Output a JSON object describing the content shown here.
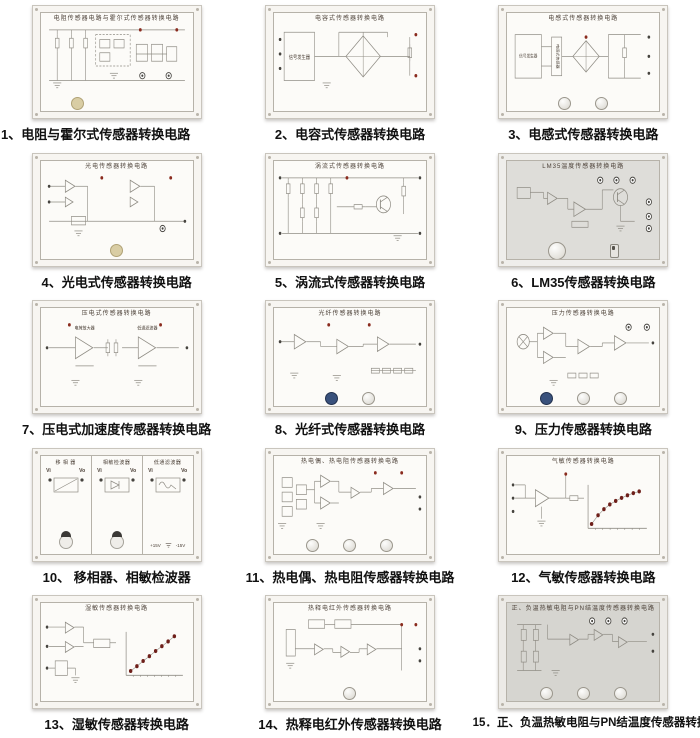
{
  "page": {
    "width": 700,
    "height": 738,
    "background": "#ffffff"
  },
  "colors": {
    "caption_text": "#111111",
    "photo_frame": "#f7f5f1",
    "frame_border": "#c9c5bd",
    "panel_face": "#fcfbf8",
    "panel_face_gray": "#deddd9",
    "panel_border": "#b6b2a9",
    "circuit_line": "#8f8c84",
    "panel_text": "#4b4037",
    "terminal_dark": "#46443f",
    "terminal_red": "#8a2b1e",
    "graph_dot": "#6e1f1a",
    "knob_navy": "#39517c",
    "knob_beige": "#d9cda4"
  },
  "items": [
    {
      "id": 1,
      "caption": "1、电阻与霍尔式传感器转换电路",
      "panel_title": "电阻传感器电路与霍尔式传感器转换电路",
      "variant": "white",
      "knobs": [
        "beige"
      ]
    },
    {
      "id": 2,
      "caption": "2、电容式传感器转换电路",
      "panel_title": "电容式传感器转换电路",
      "variant": "white",
      "labels": [
        "信号发生器"
      ],
      "knobs": []
    },
    {
      "id": 3,
      "caption": "3、电感式传感器转换电路",
      "panel_title": "电感式传感器转换电路",
      "variant": "white",
      "labels": [
        "信号发生器",
        "电感式传感器"
      ],
      "knobs": [
        "white",
        "white"
      ]
    },
    {
      "id": 4,
      "caption": "4、光电式传感器转换电路",
      "panel_title": "光电传感器转换电路",
      "variant": "white",
      "knobs": [
        "beige"
      ]
    },
    {
      "id": 5,
      "caption": "5、涡流式传感器转换电路",
      "panel_title": "涡流式传感器转换电路",
      "variant": "white",
      "knobs": []
    },
    {
      "id": 6,
      "caption": "6、LM35传感器转换电路",
      "panel_title": "LM35温度传感器转换电路",
      "variant": "gray",
      "knobs": [
        "white-lg"
      ],
      "toggle": true
    },
    {
      "id": 7,
      "caption": "7、压电式加速度传感器转换电路",
      "panel_title": "压电式传感器转换电路",
      "variant": "white",
      "labels": [
        "电荷放大器",
        "低通滤波器"
      ],
      "knobs": []
    },
    {
      "id": 8,
      "caption": "8、光纤式传感器转换电路",
      "panel_title": "光纤传感器转换电路",
      "variant": "white",
      "knobs": [
        "navy",
        "white"
      ]
    },
    {
      "id": 9,
      "caption": "9、压力传感器转换电路",
      "panel_title": "压力传感器转换电路",
      "variant": "white",
      "knobs": [
        "navy",
        "white",
        "white"
      ]
    },
    {
      "id": 10,
      "caption": "10、 移相器、相敏检波器",
      "panel_title": "",
      "variant": "white",
      "sections": [
        {
          "title": "移 相 器"
        },
        {
          "title": "相敏检波器"
        },
        {
          "title": "低通滤波器"
        }
      ],
      "terminals": {
        "in": "Vi",
        "out": "Vo"
      },
      "power": [
        "+15V",
        "-15V"
      ],
      "knobs": []
    },
    {
      "id": 11,
      "caption": "11、热电偶、热电阻传感器转换电路",
      "panel_title": "热电偶、热电阻传感器转换电路",
      "variant": "white",
      "knobs": [
        "white",
        "white",
        "white"
      ]
    },
    {
      "id": 12,
      "caption": "12、气敏传感器转换电路",
      "panel_title": "气敏传感器转换电路",
      "variant": "white",
      "knobs": [],
      "graph": {
        "type": "scatter",
        "trend": "saturating",
        "dot_color": "#6e1f1a",
        "points": [
          [
            0.06,
            0.1
          ],
          [
            0.17,
            0.3
          ],
          [
            0.27,
            0.44
          ],
          [
            0.37,
            0.55
          ],
          [
            0.47,
            0.63
          ],
          [
            0.57,
            0.7
          ],
          [
            0.67,
            0.76
          ],
          [
            0.77,
            0.81
          ],
          [
            0.87,
            0.85
          ]
        ]
      }
    },
    {
      "id": 13,
      "caption": "13、湿敏传感器转换电路",
      "panel_title": "湿敏传感器转换电路",
      "variant": "white",
      "knobs": [],
      "graph": {
        "type": "scatter",
        "trend": "linear",
        "dot_color": "#6e1f1a",
        "points": [
          [
            0.08,
            0.1
          ],
          [
            0.19,
            0.21
          ],
          [
            0.3,
            0.33
          ],
          [
            0.41,
            0.44
          ],
          [
            0.52,
            0.56
          ],
          [
            0.63,
            0.67
          ],
          [
            0.74,
            0.78
          ],
          [
            0.85,
            0.9
          ]
        ]
      }
    },
    {
      "id": 14,
      "caption": "14、热释电红外传感器转换电路",
      "panel_title": "热释电红外传感器转换电路",
      "variant": "white",
      "knobs": [
        "white"
      ]
    },
    {
      "id": 15,
      "caption": "15．正、负温热敏电阻与PN结温度传感器转换电路",
      "panel_title": "正、负温热敏电阻与PN结温度传感器转换电路",
      "variant": "gray2",
      "knobs": [
        "white",
        "white",
        "white"
      ]
    }
  ]
}
